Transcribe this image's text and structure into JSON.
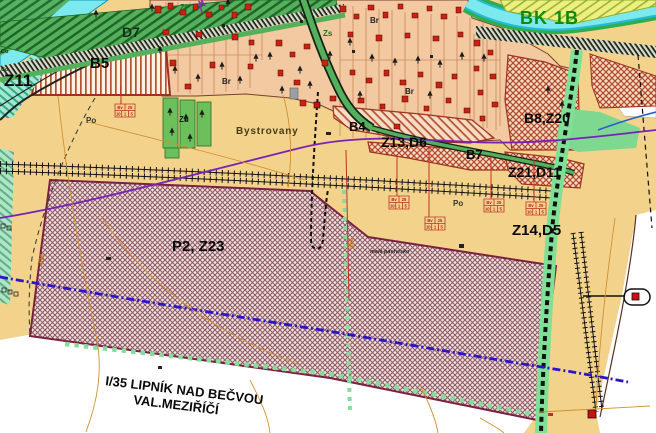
{
  "map": {
    "description": "Urban zoning plan map (územní plán) around Bystrovany",
    "labels": {
      "z11": "Z11",
      "d7": "D7",
      "b5": "B5",
      "zl": "Zl",
      "zs": "Zs",
      "bk1b": "BK 1B",
      "br": "Br",
      "zu": "Zu",
      "bystrovany": "Bystrovany",
      "b4": "B4",
      "z13d6": "Z13,D6",
      "b7": "B7",
      "b8z20": "B8,Z20",
      "z21d11": "Z21,D11",
      "z14d5": "Z14,D5",
      "p2z23": "P2, Z23",
      "po": "Po",
      "co": "Co",
      "male_pastvisko": "malé pastvisko",
      "road_line1": "I/35  LIPNÍK NAD BEČVOU",
      "road_line2": "VAL.MEZIŘÍČÍ",
      "contour_a": "230",
      "contour_b": "240"
    },
    "table_symbol": {
      "r1c1": "Bv",
      "r1c2": "25",
      "r2c1": "10",
      "r2c2": "1",
      "r2c3": "5"
    },
    "colors": {
      "background": "#f3d38c",
      "village": "#f2c9a0",
      "water": "#7ce9ee",
      "water_edge": "#27b9d8",
      "green_zone": "#55b05c",
      "green_dark": "#1e6426",
      "hatch_red": "#b5502e",
      "zone_border": "#a03020",
      "p2_border": "#7a2040",
      "corridor": "#7fe096",
      "blue_dashed": "#2c14cf",
      "purple_line": "#7a22b8",
      "blue_line": "#2860c8",
      "contour": "#cf9030",
      "house": "#cc2010",
      "label_green": "#0c8a12"
    }
  }
}
